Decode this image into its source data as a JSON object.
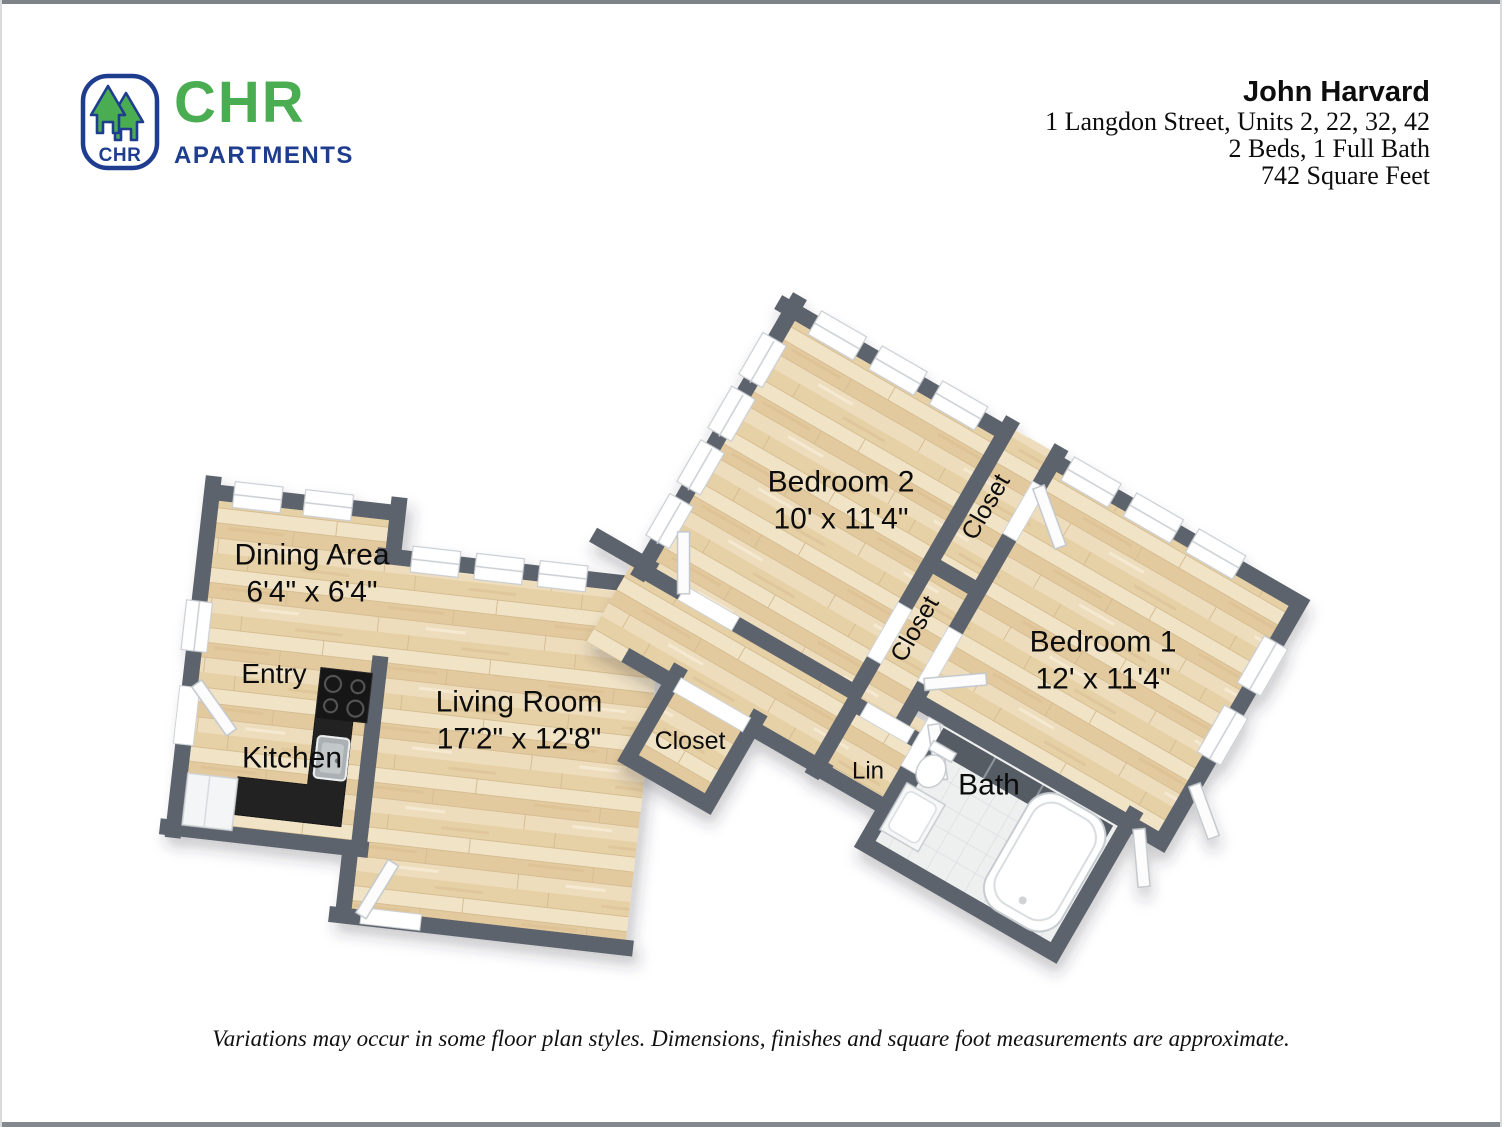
{
  "brand": {
    "logo_monogram": "CHR",
    "logo_name": "CHR",
    "logo_subtitle": "APARTMENTS",
    "green": "#4aad51",
    "navy": "#1e3d8f"
  },
  "header": {
    "title": "John Harvard",
    "address": "1 Langdon Street, Units 2, 22, 32, 42",
    "beds_baths": "2 Beds, 1 Full Bath",
    "square_feet": "742 Square Feet"
  },
  "floorplan": {
    "wall_color": "#5d646c",
    "floor_color": "#ead8b6",
    "tile_color": "#eef0f0",
    "rooms": [
      {
        "label": "Dining Area",
        "dims": "6'4\" x 6'4\""
      },
      {
        "label": "Entry"
      },
      {
        "label": "Kitchen"
      },
      {
        "label": "Living Room",
        "dims": "17'2\" x 12'8\""
      },
      {
        "label": "Closet"
      },
      {
        "label": "Bedroom 2",
        "dims": "10' x 11'4\""
      },
      {
        "label": "Closet"
      },
      {
        "label": "Closet"
      },
      {
        "label": "Bedroom 1",
        "dims": "12' x 11'4\""
      },
      {
        "label": "Lin"
      },
      {
        "label": "Bath"
      }
    ]
  },
  "footer": {
    "disclaimer": "Variations may occur in some floor plan styles. Dimensions, finishes and square foot measurements are approximate."
  }
}
